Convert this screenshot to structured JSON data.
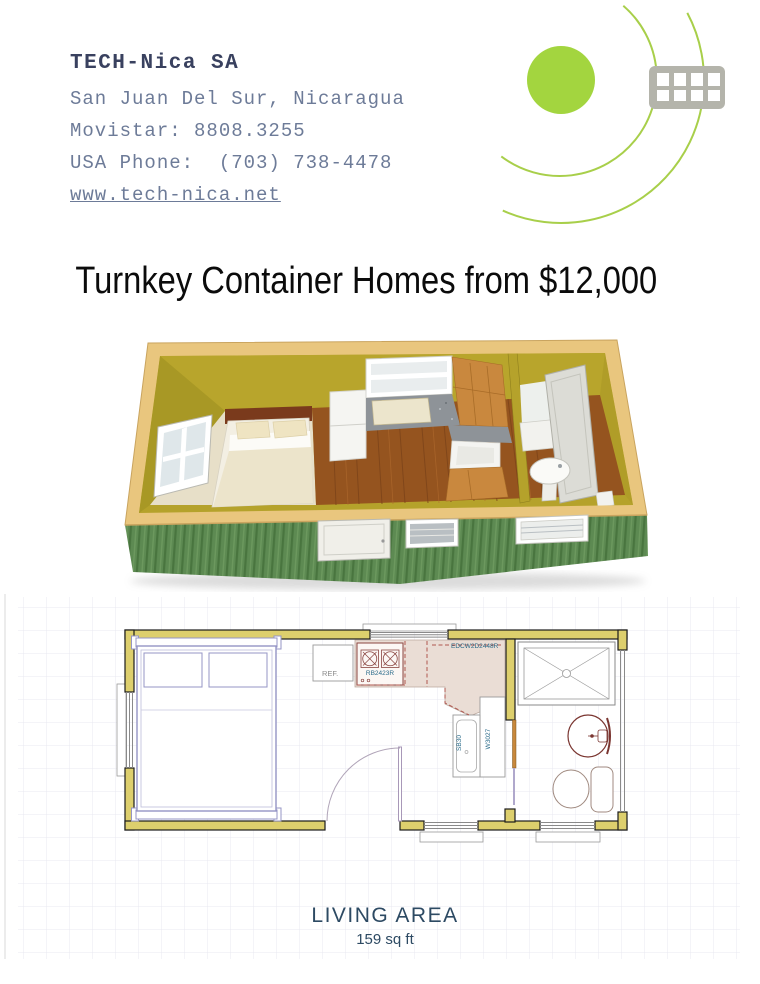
{
  "header": {
    "company": "TECH-Nica SA",
    "location": "San Juan Del Sur, Nicaragua",
    "movistar": "Movistar: 8808.3255",
    "usa_phone": "USA Phone:  (703) 738-4478",
    "website": "www.tech-nica.net"
  },
  "logo": {
    "circle_color": "#a3d53f",
    "arc_color": "#a8cf4a",
    "grid_icon_color": "#b4b4ab"
  },
  "headline": {
    "text": "Turnkey Container Homes from $12,000"
  },
  "colors": {
    "wall_yellow": "#ddcf6d",
    "interior_olive": "#b5a22b",
    "exterior_green": "#5d8a52",
    "wood_trim": "#e9c67e",
    "floor_wood": "#95541f",
    "plan_label_blue": "#2a6b8a",
    "living_area_text": "#2d4a63"
  },
  "floorplan": {
    "labels": {
      "ref": "REF.",
      "range": "RB2423R",
      "corner_cabinet": "EDCW2D2448R",
      "sink_base": "SB30",
      "wall_cabinet": "W3027"
    },
    "living_area": {
      "title": "LIVING AREA",
      "area": "159 sq ft"
    }
  }
}
